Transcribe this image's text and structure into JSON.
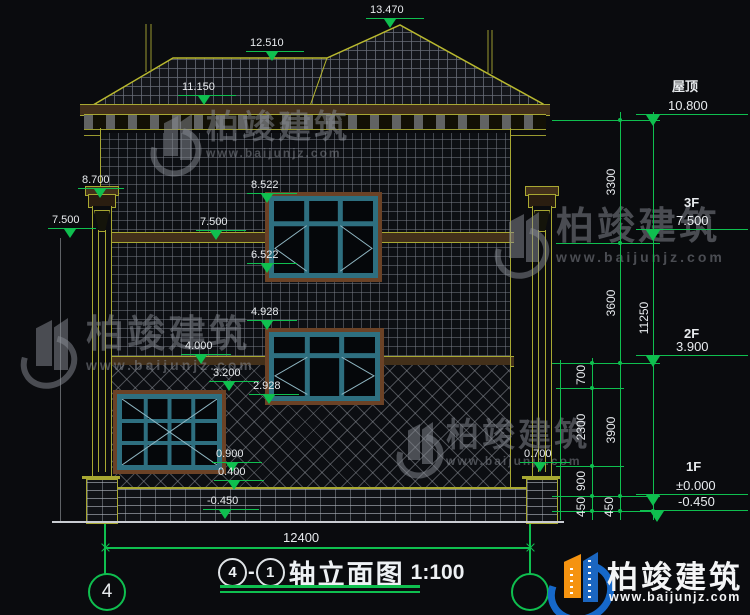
{
  "title": {
    "axis_start": "4",
    "sep": "-",
    "axis_end": "1",
    "name": "轴立面图",
    "scale": "1:100"
  },
  "axis_bubbles": {
    "left": "4"
  },
  "bottom_dim": "12400",
  "left_markers": [
    "13.470",
    "12.510",
    "11.150",
    "8.700",
    "7.500",
    "8.522",
    "7.500",
    "6.522",
    "4.928",
    "4.000",
    "3.200",
    "2.928",
    "0.900",
    "0.400",
    "-0.450",
    "0.700"
  ],
  "levels": [
    {
      "name": "屋顶",
      "elev": "10.800"
    },
    {
      "name": "3F",
      "elev": "7.500"
    },
    {
      "name": "2F",
      "elev": "3.900"
    },
    {
      "name": "1F",
      "elev": "±0.000"
    },
    {
      "name": "",
      "elev": "-0.450"
    }
  ],
  "vdims": {
    "inner": [
      "700",
      "2300",
      "900",
      "450"
    ],
    "floors": [
      "3300",
      "3600",
      "3900",
      "450"
    ],
    "total": "11250"
  },
  "watermark": {
    "brand": "柏竣建筑",
    "url": "www.baijunjz.com"
  },
  "colors": {
    "background": "#0a0b0e",
    "line_olive": "#b9b92f",
    "annotation_green": "#0fbf4f",
    "text_white": "#e8ebee",
    "window_teal": "#2e6f80",
    "logo_blue": "#1668c9",
    "logo_orange": "#f59310"
  }
}
